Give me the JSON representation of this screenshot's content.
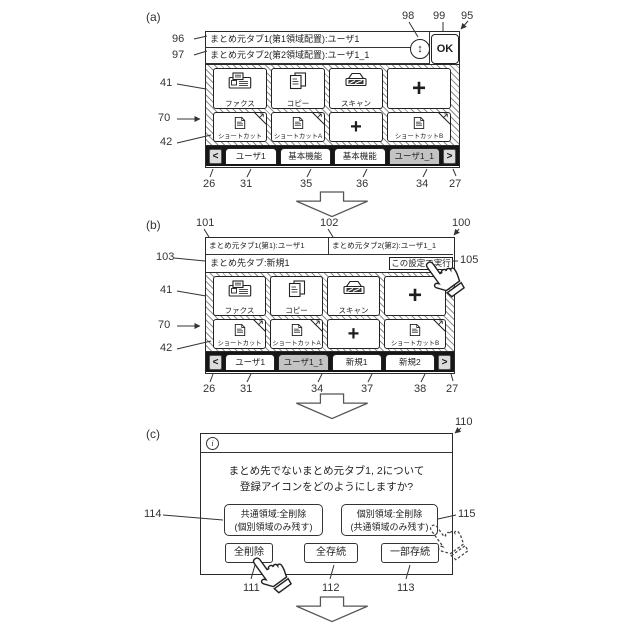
{
  "icons": {
    "swap_vertical": "↕",
    "info": "i",
    "nav_prev": "<",
    "nav_next": ">"
  },
  "colors": {
    "selected_tab": "#c3c3c3",
    "outline": "#222222",
    "tabbar_bg": "#161616"
  },
  "figure_a": {
    "label": "(a)",
    "source_rows": [
      "まとめ元タブ1(第1領域配置):ユーザ1",
      "まとめ元タブ2(第2領域配置):ユーザ1_1"
    ],
    "ok_label": "OK",
    "tiles_row1": [
      {
        "label": "ファクス"
      },
      {
        "label": "コピー"
      },
      {
        "label": "スキャン"
      },
      {
        "label": "+"
      }
    ],
    "tiles_row2": [
      {
        "label": "ショートカット"
      },
      {
        "label": "ショートカットA"
      },
      {
        "label": "+"
      },
      {
        "label": "ショートカットB"
      }
    ],
    "tabs": [
      {
        "label": "ユーザ1",
        "selected": false
      },
      {
        "label": "基本機能",
        "selected": false
      },
      {
        "label": "基本機能",
        "selected": false
      },
      {
        "label": "ユーザ1_1",
        "selected": true
      }
    ],
    "refs": {
      "r96": "96",
      "r97": "97",
      "r41": "41",
      "r70": "70",
      "r42": "42",
      "r98": "98",
      "r99": "99",
      "r95": "95",
      "r26": "26",
      "r31": "31",
      "r35": "35",
      "r36": "36",
      "r34": "34",
      "r27": "27"
    }
  },
  "figure_b": {
    "label": "(b)",
    "source_cells": [
      "まとめ元タブ1(第1):ユーザ1",
      "まとめ元タブ2(第2):ユーザ1_1"
    ],
    "dest_label": "まとめ先タブ:新規1",
    "execute_button": "この設定で実行",
    "tiles_row1": [
      {
        "label": "ファクス"
      },
      {
        "label": "コピー"
      },
      {
        "label": "スキャン"
      },
      {
        "label": "+"
      }
    ],
    "tiles_row2": [
      {
        "label": "ショートカット"
      },
      {
        "label": "ショートカットA"
      },
      {
        "label": "+"
      },
      {
        "label": "ショートカットB"
      }
    ],
    "tabs": [
      {
        "label": "ユーザ1",
        "selected": false
      },
      {
        "label": "ユーザ1_1",
        "selected": true
      },
      {
        "label": "新規1",
        "selected": false
      },
      {
        "label": "新規2",
        "selected": false
      }
    ],
    "refs": {
      "r101": "101",
      "r102": "102",
      "r100": "100",
      "r103": "103",
      "r105": "105",
      "r41": "41",
      "r70": "70",
      "r42": "42",
      "r26": "26",
      "r31": "31",
      "r34": "34",
      "r37": "37",
      "r38": "38",
      "r27": "27"
    }
  },
  "figure_c": {
    "label": "(c)",
    "message_lines": [
      "まとめ先でないまとめ元タブ1, 2について",
      "登録アイコンをどのようにしますか?"
    ],
    "options": [
      {
        "line1": "共通領域:全削除",
        "line2": "(個別領域のみ残す)"
      },
      {
        "line1": "個別領域:全削除",
        "line2": "(共通領域のみ残す)"
      }
    ],
    "buttons": [
      {
        "label": "全削除"
      },
      {
        "label": "全存続"
      },
      {
        "label": "一部存続"
      }
    ],
    "refs": {
      "r110": "110",
      "r114": "114",
      "r115": "115",
      "r111": "111",
      "r112": "112",
      "r113": "113"
    }
  }
}
